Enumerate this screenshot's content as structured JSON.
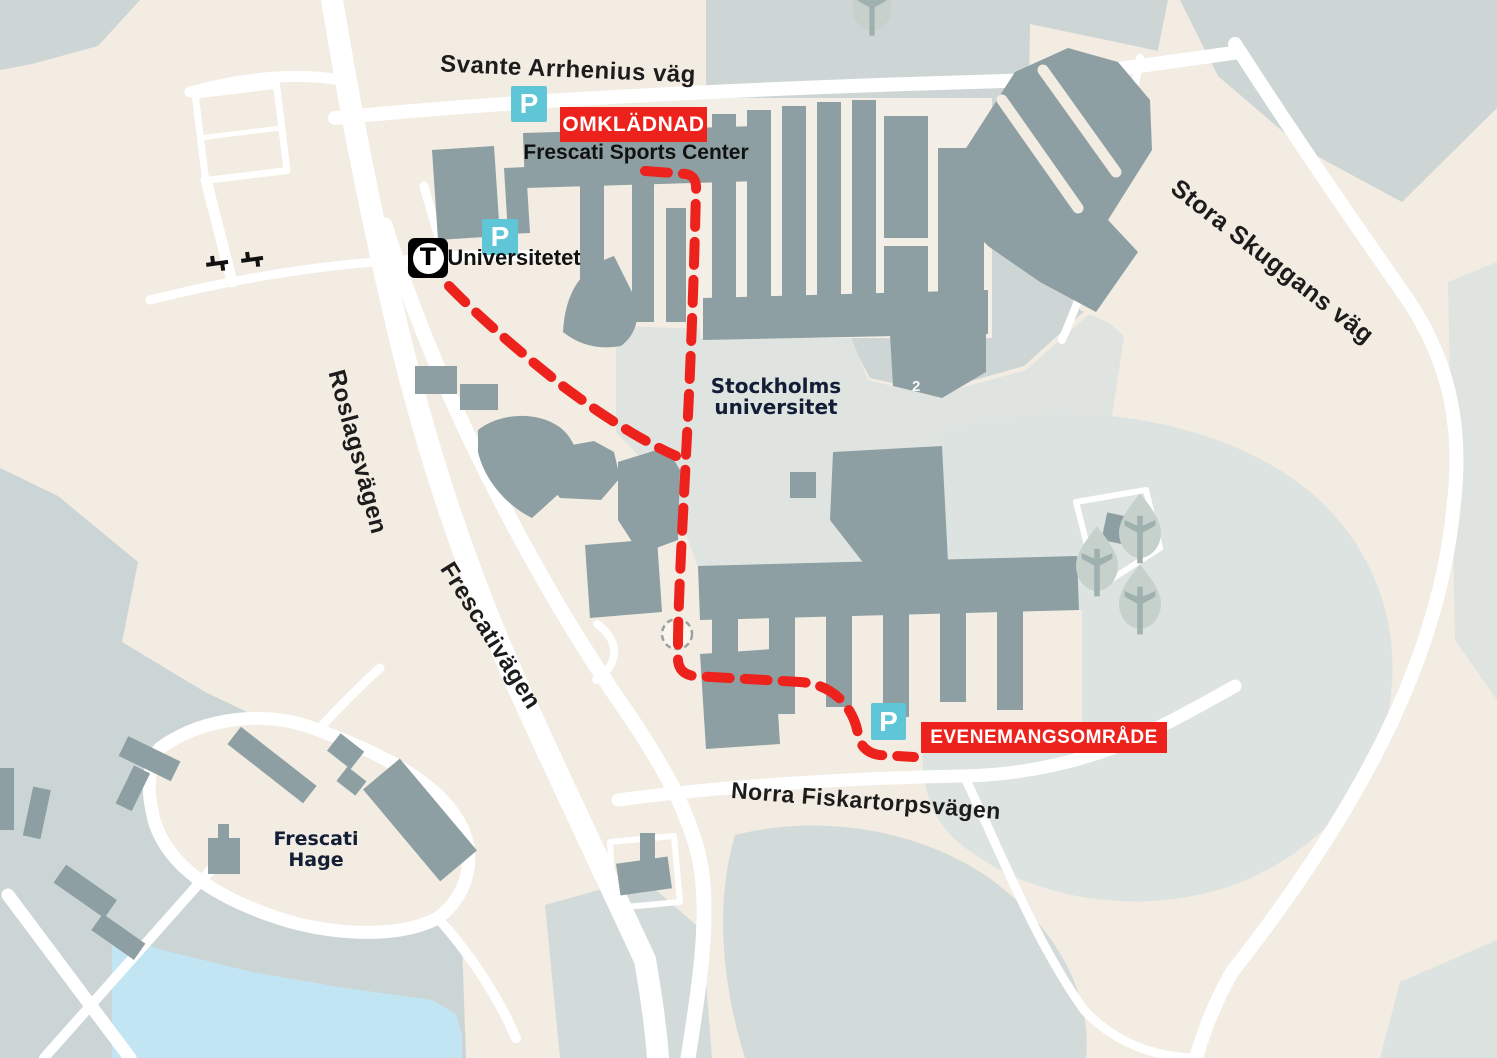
{
  "colors": {
    "background_beige": "#f2ece2",
    "area_gray": "#cdd5d5",
    "area_light_gray": "#dfe4e1",
    "water_blue": "#c2e5f3",
    "building_gray": "#8d9fa2",
    "road_white": "#ffffff",
    "route_red": "#ee221c",
    "parking_teal": "#5ec6d6",
    "metro_black": "#000000",
    "navy_label": "#121d36"
  },
  "roads": {
    "svante_arrhenius": "Svante Arrhenius väg",
    "roslagsvagen": "Roslagsvägen",
    "frescativagen": "Frescativägen",
    "stora_skuggans": "Stora Skuggans väg",
    "norra_fiskartorpsvagen": "Norra Fiskartorpsvägen"
  },
  "places": {
    "sports_center": "Frescati Sports Center",
    "university_line1": "Stockholms",
    "university_line2": "universitet",
    "hage_line1": "Frescati",
    "hage_line2": "Hage",
    "metro_station": "Universitetet",
    "building_number": "2"
  },
  "banners": {
    "changing_rooms": "OMKLÄDNAD",
    "event_area": "EVENEMANGSOMRÅDE"
  },
  "icons": {
    "parking_letter": "P",
    "metro_letter": "T"
  }
}
